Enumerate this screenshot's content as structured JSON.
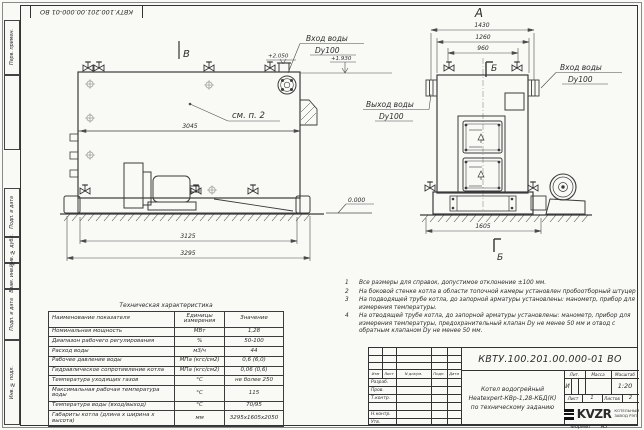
{
  "sheet": {
    "corner_stamp": "КВТУ.100.201.00.000-01 ВО",
    "format_label": "Формат",
    "format_value": "А3",
    "margin_labels": [
      "Перв. примен.",
      "Подп. и дата",
      "Инв. № дубл.",
      "Взам. инв. №",
      "Подп. и дата",
      "Инв. № подл."
    ]
  },
  "drawing": {
    "side_view": {
      "view_mark": "В",
      "detail_note": "см. п. 2",
      "inlet_line1": "Вход воды",
      "inlet_line2": "Dy100",
      "elev_nozzle": "+2.050",
      "elev_top": "+1.930",
      "level_mark": "0.000",
      "dim_body": "3045",
      "dim_frame": "3125",
      "dim_overall": "3295"
    },
    "front_view": {
      "view_label": "А",
      "section_label_top": "Б",
      "section_label_bottom": "Б",
      "dim_width_overall": "1430",
      "dim_width_flanges": "1260",
      "dim_width_valves": "960",
      "dim_base": "1605",
      "inlet_line1": "Вход воды",
      "inlet_line2": "Dy100",
      "outlet_line1": "Выход воды",
      "outlet_line2": "Dy100"
    }
  },
  "notes": {
    "items": [
      {
        "num": "1",
        "text": "Все размеры для справок, допустимое отклонение ±100 мм."
      },
      {
        "num": "2",
        "text": "На боковой стенке котла в области топочной камеры установлен пробоотборный штуцер"
      },
      {
        "num": "3",
        "text": "На подводящей трубе котла, до запорной арматуры установлены: манометр, прибор для измерения температуры."
      },
      {
        "num": "4",
        "text": "На отводящей трубе котла, до запорной арматуры установлены: манометр, прибор для измерения температуры, предохранительный клапан Dу не менее 50 мм и отвод с обратным клапаном Dу не менее 50 мм."
      }
    ]
  },
  "spec_table": {
    "title": "Техническая характеристика",
    "headers": [
      "Наименование показателя",
      "Единицы измерения",
      "Значение"
    ],
    "rows": [
      [
        "Номинальная мощность",
        "МВт",
        "1,28"
      ],
      [
        "Диапазон рабочего регулирования",
        "%",
        "50-100"
      ],
      [
        "Расход воды",
        "м3/ч",
        "44"
      ],
      [
        "Рабочее давление воды",
        "МПа (кгс/см2)",
        "0,6 (6,0)"
      ],
      [
        "Гидравлическое сопротивление котла",
        "МПа (кгс/см2)",
        "0,06 (0,6)"
      ],
      [
        "Температура уходящих газов",
        "°С",
        "не более 250"
      ],
      [
        "Максимальная рабочая температура воды",
        "°С",
        "115"
      ],
      [
        "Температура воды (вход/выход)",
        "°С",
        "70/95"
      ],
      [
        "Габариты котла (длина х ширина х высота)",
        "мм",
        "3295х1605х2050"
      ]
    ]
  },
  "title_block": {
    "designation": "КВТУ.100.201.00.000-01 ВО",
    "name_line1": "Котел водогрейный",
    "name_line2": "Heatexpert-КВр-1,28-КБД(К)",
    "name_line3": "по техническому заданию",
    "header_cols": [
      "Изм",
      "Лист",
      "N докум.",
      "Подп.",
      "Дата"
    ],
    "row_labels": [
      "Разраб.",
      "Пров.",
      "Т.контр.",
      "Н.контр.",
      "Утв."
    ],
    "lit_label": "Лит.",
    "lit_value": "И",
    "mass_label": "Масса",
    "scale_label": "Масштаб",
    "scale_value": "1:20",
    "sheet_label": "Лист",
    "sheet_value": "1",
    "sheets_label": "Листов",
    "sheets_value": "2",
    "logo_word": "KVZR",
    "company_line1": "КОТЕЛЬНЫЙ",
    "company_line2": "ЗАВОД РЭП"
  }
}
